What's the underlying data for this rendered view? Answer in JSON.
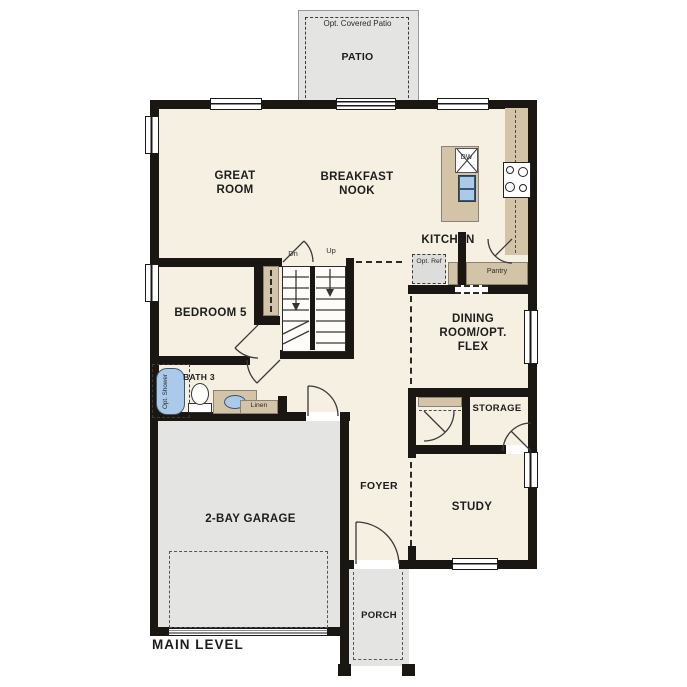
{
  "title": "Main level floor plan",
  "level_label": "MAIN LEVEL",
  "outdoor": {
    "patio_option": "Opt. Covered Patio",
    "patio": "PATIO",
    "porch": "PORCH"
  },
  "rooms": {
    "great_room": "GREAT ROOM",
    "breakfast_nook": "BREAKFAST NOOK",
    "kitchen": "KITCHEN",
    "bedroom_5": "BEDROOM 5",
    "bath_3": "BATH 3",
    "dining": "DINING ROOM/OPT. FLEX",
    "storage": "STORAGE",
    "foyer": "FOYER",
    "study": "STUDY",
    "garage": "2-BAY GARAGE"
  },
  "annotations": {
    "stairs_down": "Dn",
    "stairs_up": "Up",
    "dishwasher": "DW",
    "opt_ref": "Opt. Ref",
    "pantry": "Pantry",
    "linen": "Linen",
    "opt_shower": "Opt. Shower"
  },
  "colors": {
    "wall": "#1a1713",
    "interior": "#f6f0e3",
    "exterior_concrete": "#e4e4e2",
    "casework": "#d3c4a7",
    "plumbing_blue": "#abc9e9"
  }
}
